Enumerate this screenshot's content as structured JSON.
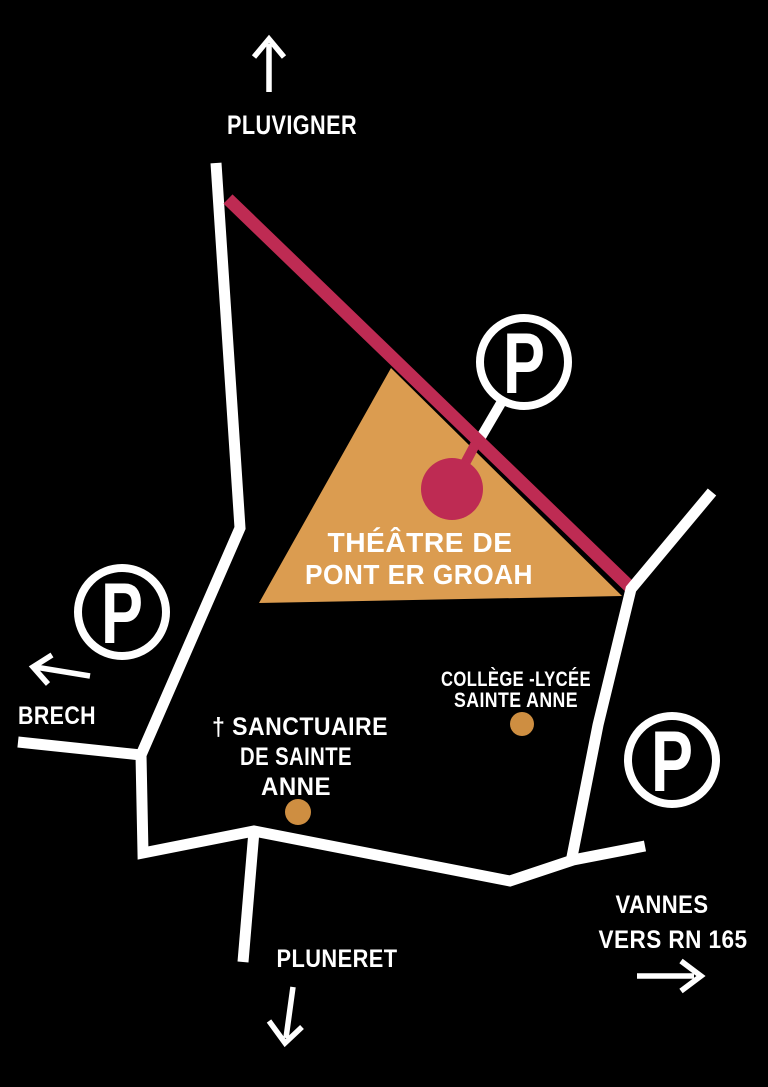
{
  "colors": {
    "background": "#000000",
    "road": "#ffffff",
    "route_highlight": "#be2b53",
    "theatre_zone": "#db9c50",
    "poi_dot": "#ce8e41"
  },
  "parking": {
    "symbol": "P"
  },
  "directions": {
    "north": "PLUVIGNER",
    "west": "BRECH",
    "south": "PLUNERET",
    "east_line1": "VANNES",
    "east_line2": "VERS RN 165"
  },
  "places": {
    "theatre": {
      "line1": "THÉÂTRE DE",
      "line2": "PONT ER GROAH"
    },
    "sanctuaire": {
      "line1": "† SANCTUAIRE",
      "line2": "DE SAINTE",
      "line3": "ANNE"
    },
    "college": {
      "line1": "COLLÈGE -LYCÉE",
      "line2": "SAINTE ANNE"
    }
  }
}
